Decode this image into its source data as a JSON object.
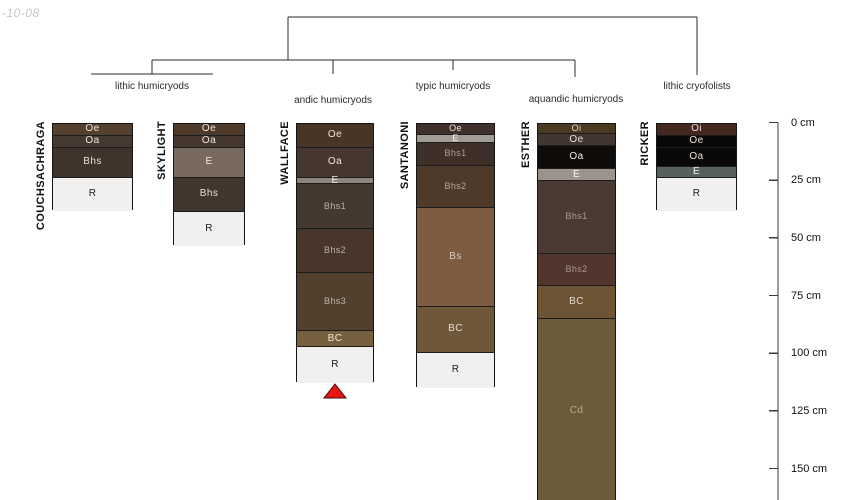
{
  "watermark": "-10-08",
  "figure": {
    "canvas": {
      "width": 850,
      "height": 500,
      "background": "#ffffff"
    },
    "scale": {
      "zero_y": 122.5,
      "px_per_cm": 2.3067
    },
    "axis": {
      "unit": "cm",
      "x": 778,
      "bottom_y": 500,
      "tick_len": 9,
      "label_x": 791,
      "line_color": "#3c3c3c",
      "ticks": [
        {
          "cm": 0,
          "label": "0 cm"
        },
        {
          "cm": 25,
          "label": "25 cm"
        },
        {
          "cm": 50,
          "label": "50 cm"
        },
        {
          "cm": 75,
          "label": "75 cm"
        },
        {
          "cm": 100,
          "label": "100 cm"
        },
        {
          "cm": 125,
          "label": "125 cm"
        },
        {
          "cm": 150,
          "label": "150 cm"
        }
      ]
    },
    "tree": {
      "line_color": "#2b2b2b",
      "segments": [
        [
          288,
          17,
          697,
          17
        ],
        [
          288,
          17,
          288,
          60
        ],
        [
          697,
          17,
          697,
          75
        ],
        [
          152,
          60,
          575,
          60
        ],
        [
          152,
          60,
          152,
          74
        ],
        [
          91,
          74,
          213,
          74
        ],
        [
          333,
          60,
          333,
          74
        ],
        [
          453,
          60,
          453,
          70
        ],
        [
          575,
          60,
          575,
          77
        ]
      ],
      "groups": [
        {
          "label": "lithic humicryods",
          "x": 152,
          "y": 81
        },
        {
          "label": "andic humicryods",
          "x": 333,
          "y": 95
        },
        {
          "label": "typic humicryods",
          "x": 453,
          "y": 81
        },
        {
          "label": "aquandic humicryods",
          "x": 576,
          "y": 94
        },
        {
          "label": "lithic cryofolists",
          "x": 697,
          "y": 81
        }
      ]
    },
    "profiles": [
      {
        "name": "COUCHSACHRAGA",
        "x": 52,
        "width": 81,
        "horizons": [
          {
            "label": "Oe",
            "top_cm": 0,
            "bottom_cm": 5,
            "fill": "#53402f",
            "text": "#eee6de"
          },
          {
            "label": "Oa",
            "top_cm": 5,
            "bottom_cm": 10,
            "fill": "#463931",
            "text": "#eee6de"
          },
          {
            "label": "Bhs",
            "top_cm": 10,
            "bottom_cm": 23,
            "fill": "#3f332c",
            "text": "#e8e0d8"
          },
          {
            "label": "R",
            "top_cm": 23,
            "bottom_cm": 38,
            "fill": "#f1f0ee",
            "text": "#1a1a1a"
          }
        ]
      },
      {
        "name": "SKYLIGHT",
        "x": 173,
        "width": 72,
        "horizons": [
          {
            "label": "Oe",
            "top_cm": 0,
            "bottom_cm": 5,
            "fill": "#4d3a2a",
            "text": "#eee6de"
          },
          {
            "label": "Oa",
            "top_cm": 5,
            "bottom_cm": 10,
            "fill": "#463831",
            "text": "#eee6de"
          },
          {
            "label": "E",
            "top_cm": 10,
            "bottom_cm": 23,
            "fill": "#786a5f",
            "text": "#f0eae4"
          },
          {
            "label": "Bhs",
            "top_cm": 23,
            "bottom_cm": 38,
            "fill": "#42352e",
            "text": "#e8e0d8"
          },
          {
            "label": "R",
            "top_cm": 38,
            "bottom_cm": 53,
            "fill": "#f1f0ee",
            "text": "#1a1a1a"
          }
        ]
      },
      {
        "name": "WALLFACE",
        "x": 296,
        "width": 78,
        "horizons": [
          {
            "label": "Oe",
            "top_cm": 0,
            "bottom_cm": 10,
            "fill": "#483525",
            "text": "#eee6de"
          },
          {
            "label": "Oa",
            "top_cm": 10,
            "bottom_cm": 23,
            "fill": "#453730",
            "text": "#eee6de"
          },
          {
            "label": "E",
            "top_cm": 23,
            "bottom_cm": 26,
            "fill": "#8d857c",
            "text": "#f2ece6"
          },
          {
            "label": "Bhs1",
            "top_cm": 26,
            "bottom_cm": 45.5,
            "fill": "#453831",
            "text": "#b9b0a8",
            "fs": 9
          },
          {
            "label": "Bhs2",
            "top_cm": 45.5,
            "bottom_cm": 64.5,
            "fill": "#48362b",
            "text": "#b9b0a8",
            "fs": 9
          },
          {
            "label": "Bhs3",
            "top_cm": 64.5,
            "bottom_cm": 89.5,
            "fill": "#52402f",
            "text": "#bdb4ac",
            "fs": 9
          },
          {
            "label": "BC",
            "top_cm": 89.5,
            "bottom_cm": 96.5,
            "fill": "#77603f",
            "text": "#ece4da"
          },
          {
            "label": "R",
            "top_cm": 96.5,
            "bottom_cm": 112.5,
            "fill": "#f1f0ee",
            "text": "#1a1a1a"
          }
        ]
      },
      {
        "name": "SANTANONI",
        "x": 416,
        "width": 79,
        "horizons": [
          {
            "label": "Oe",
            "top_cm": 0,
            "bottom_cm": 4.5,
            "fill": "#40322a",
            "text": "#ece4dc",
            "fs": 9
          },
          {
            "label": "E",
            "top_cm": 4.5,
            "bottom_cm": 8,
            "fill": "#a29c96",
            "text": "#f6f2ee",
            "fs": 9
          },
          {
            "label": "Bhs1",
            "top_cm": 8,
            "bottom_cm": 18,
            "fill": "#3e3029",
            "text": "#aaa29a",
            "fs": 9
          },
          {
            "label": "Bhs2",
            "top_cm": 18,
            "bottom_cm": 36,
            "fill": "#4e3a2b",
            "text": "#b4a89e",
            "fs": 9
          },
          {
            "label": "Bs",
            "top_cm": 36,
            "bottom_cm": 79,
            "fill": "#7e5c41",
            "text": "#d8ccc2"
          },
          {
            "label": "BC",
            "top_cm": 79,
            "bottom_cm": 99,
            "fill": "#6f5839",
            "text": "#e4dcd2"
          },
          {
            "label": "R",
            "top_cm": 99,
            "bottom_cm": 114.5,
            "fill": "#f1f0ee",
            "text": "#1a1a1a"
          }
        ]
      },
      {
        "name": "ESTHER",
        "x": 537,
        "width": 79,
        "horizons": [
          {
            "label": "Oi",
            "top_cm": 0,
            "bottom_cm": 4,
            "fill": "#4a3a22",
            "text": "#e0d8ce",
            "fs": 9
          },
          {
            "label": "Oe",
            "top_cm": 4,
            "bottom_cm": 9.5,
            "fill": "#433630",
            "text": "#e8e0d8"
          },
          {
            "label": "Oa",
            "top_cm": 9.5,
            "bottom_cm": 19.5,
            "fill": "#0e0b09",
            "text": "#f2eee8"
          },
          {
            "label": "E",
            "top_cm": 19.5,
            "bottom_cm": 24.5,
            "fill": "#9c948c",
            "text": "#f6f2ee"
          },
          {
            "label": "Bhs1",
            "top_cm": 24.5,
            "bottom_cm": 56,
            "fill": "#4a3a32",
            "text": "#a89e96",
            "fs": 9
          },
          {
            "label": "Bhs2",
            "top_cm": 56,
            "bottom_cm": 70,
            "fill": "#52362d",
            "text": "#a89890",
            "fs": 9
          },
          {
            "label": "BC",
            "top_cm": 70,
            "bottom_cm": 84.5,
            "fill": "#6c5435",
            "text": "#e4dcd2"
          },
          {
            "label": "Cd",
            "top_cm": 84.5,
            "bottom_cm": 164,
            "fill": "#6c5b3a",
            "text": "#b4ab98"
          }
        ]
      },
      {
        "name": "RICKER",
        "x": 656,
        "width": 81,
        "horizons": [
          {
            "label": "Oi",
            "top_cm": 0,
            "bottom_cm": 5,
            "fill": "#44281f",
            "text": "#e8ded8"
          },
          {
            "label": "Oe",
            "top_cm": 5,
            "bottom_cm": 10,
            "fill": "#0b0908",
            "text": "#e8e2dc"
          },
          {
            "label": "Oa",
            "top_cm": 10,
            "bottom_cm": 18.5,
            "fill": "#0b0908",
            "text": "#e8e2dc"
          },
          {
            "label": "E",
            "top_cm": 18.5,
            "bottom_cm": 23,
            "fill": "#56605f",
            "text": "#eef2f0"
          },
          {
            "label": "R",
            "top_cm": 23,
            "bottom_cm": 38,
            "fill": "#f1f0ee",
            "text": "#1a1a1a"
          }
        ]
      }
    ],
    "marker": {
      "shape": "triangle-up",
      "cx": 335,
      "top_y": 384,
      "width": 22,
      "height": 14,
      "fill": "#e81313",
      "stroke": "#3d0b0b"
    }
  }
}
